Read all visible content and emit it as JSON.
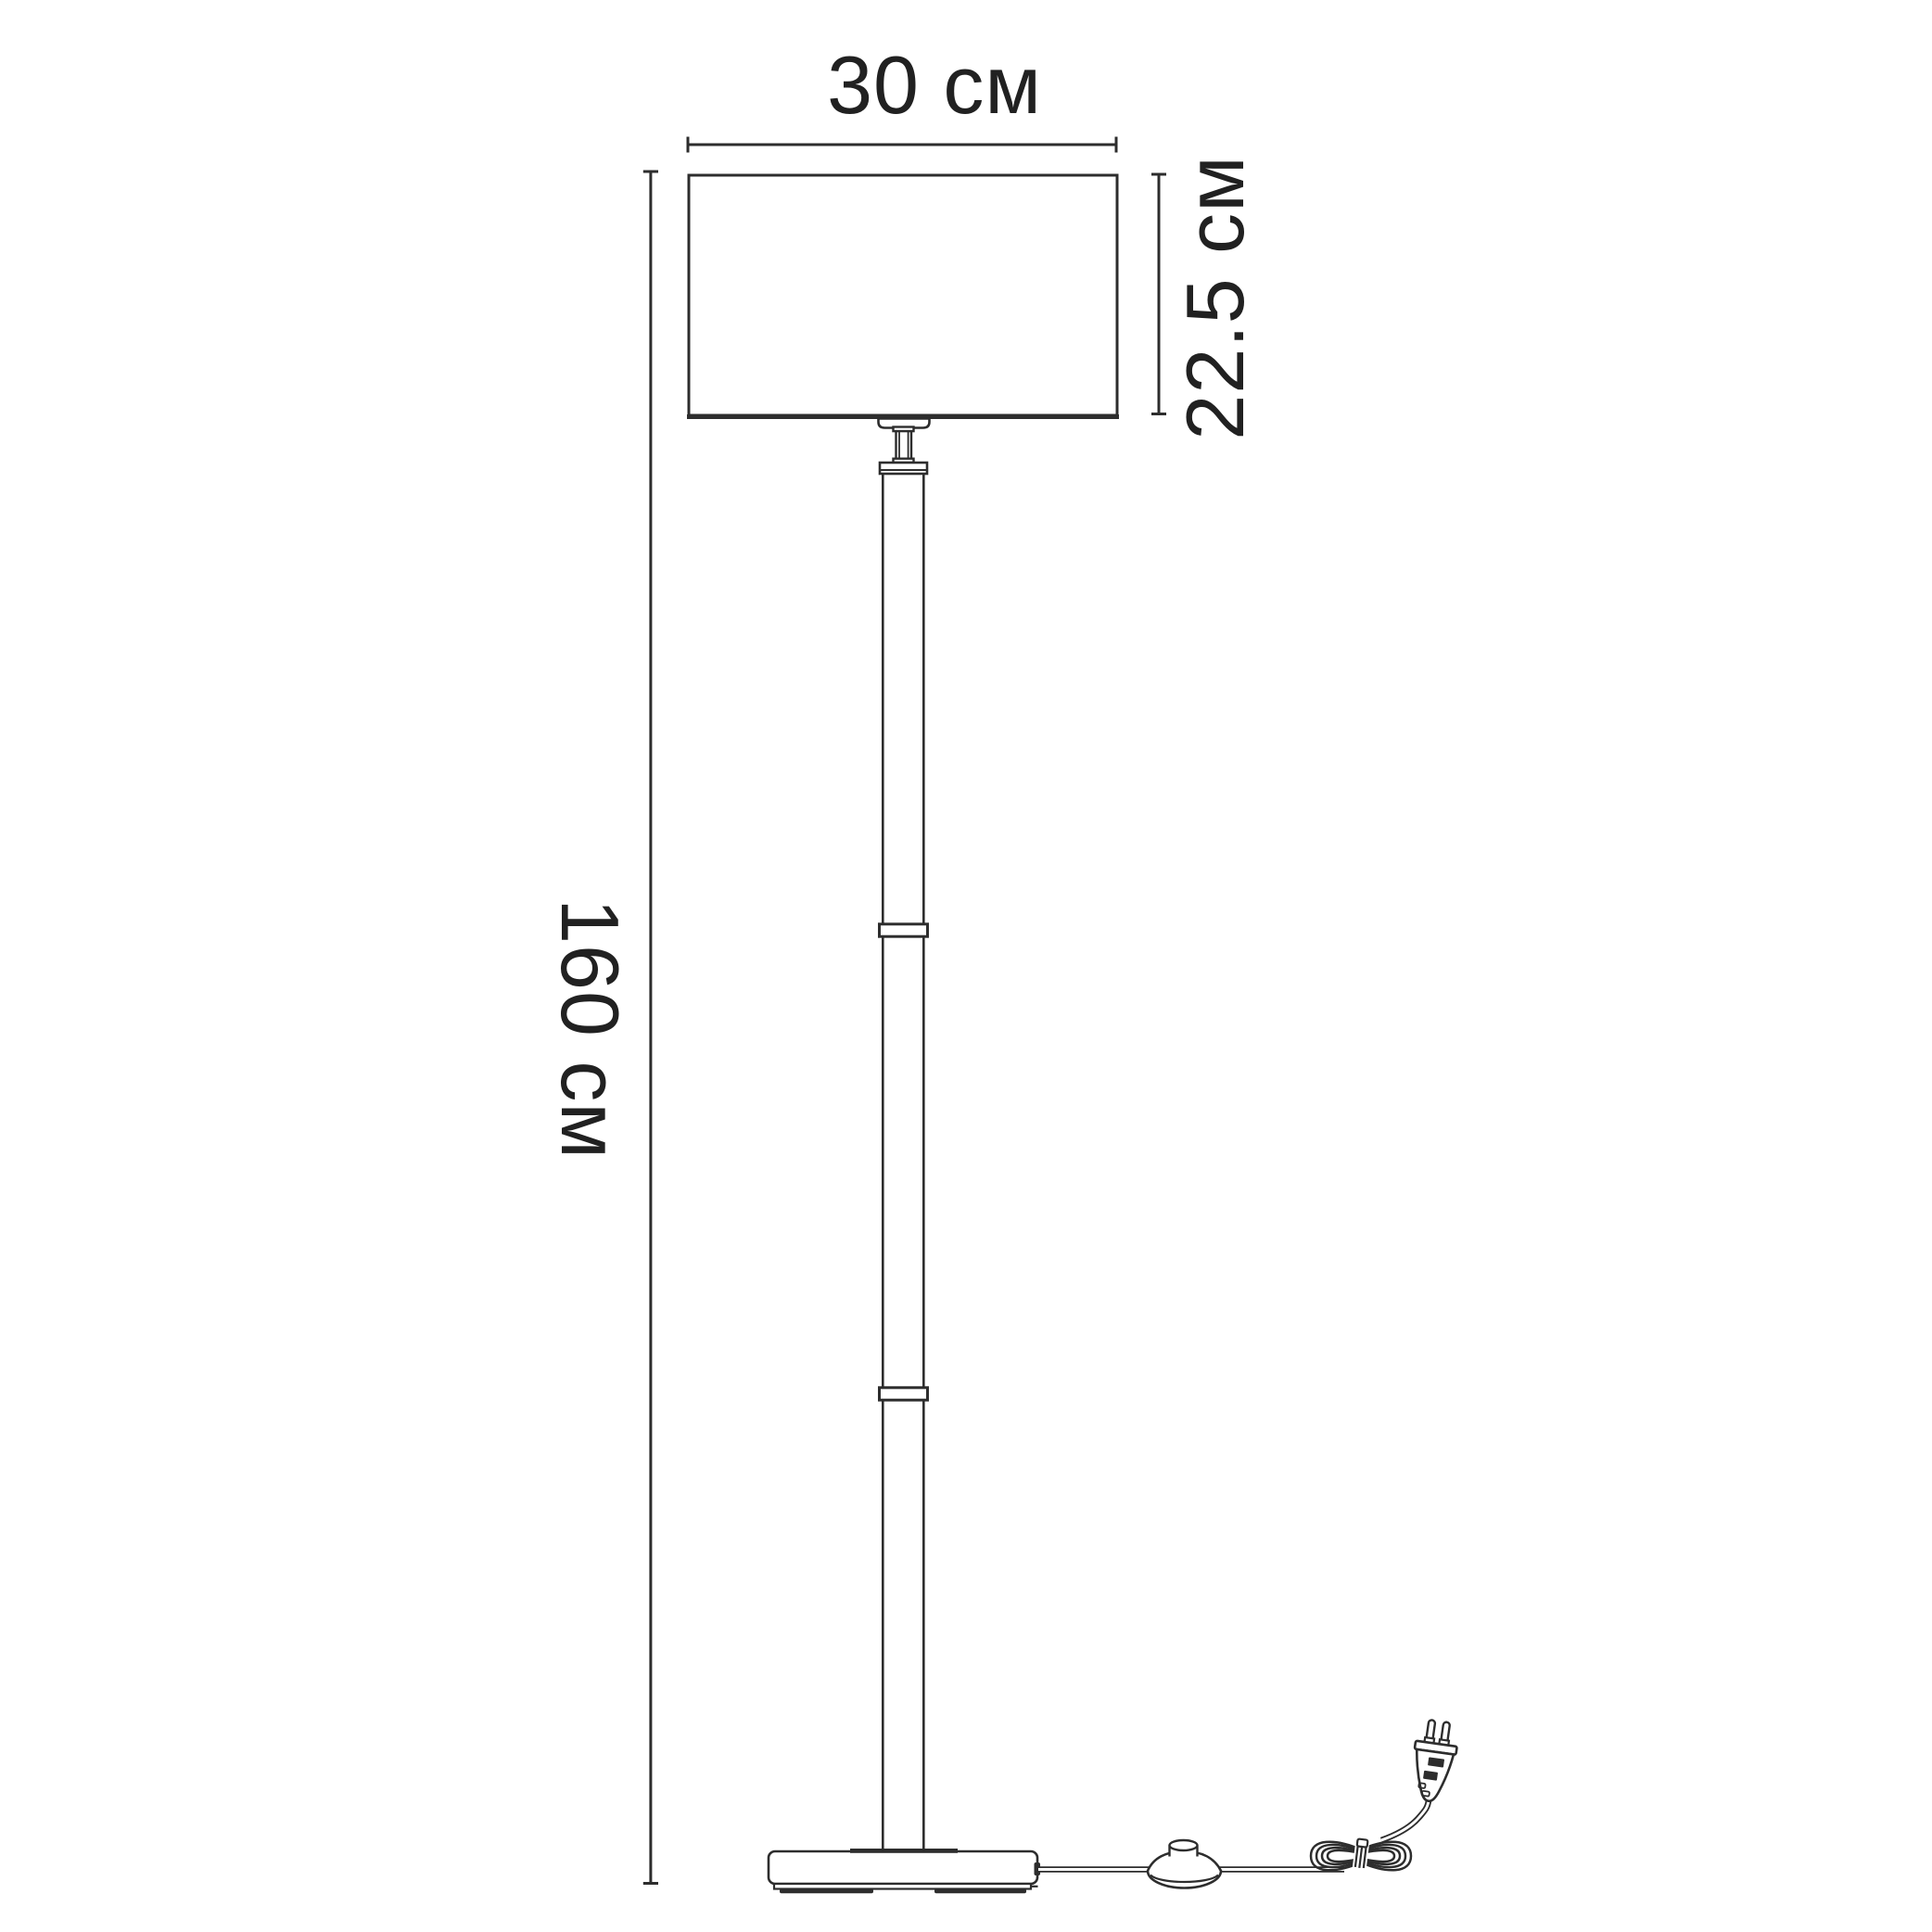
{
  "diagram_title": "Floor lamp dimension drawing",
  "labels": {
    "shade_width": "30 см",
    "shade_height": "22.5 см",
    "total_height": "160 см"
  },
  "colors": {
    "background": "#ffffff",
    "line": "#2d2d2d",
    "text": "#212121"
  }
}
